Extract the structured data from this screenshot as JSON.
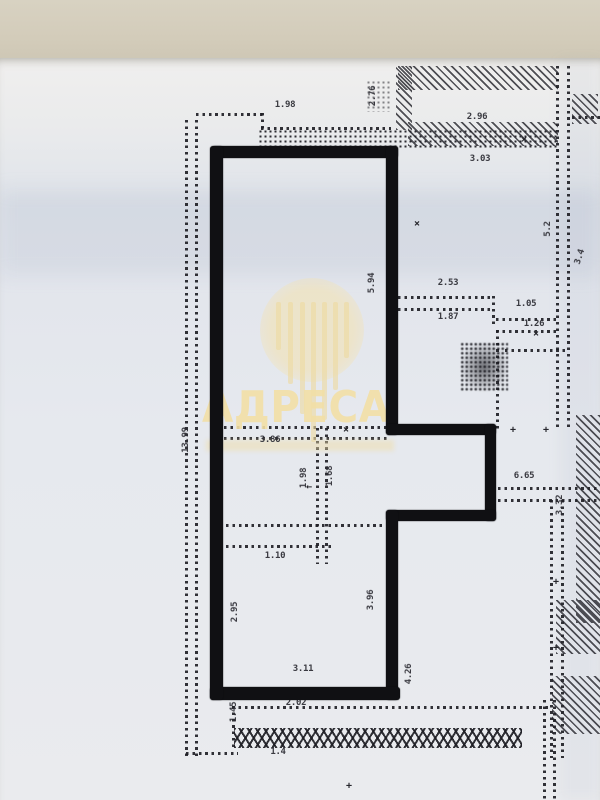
{
  "scene": {
    "description_kind": "photographed apartment floor plan with marked unit",
    "colors": {
      "table_top": "#d3ccba",
      "paper": "#e8eaee",
      "plan_ink": "#26262c",
      "marker_outline": "#101013",
      "watermark": "#f2dfa5"
    }
  },
  "watermark": {
    "text": "АДРЕСА",
    "logo": "circle-with-dripping-columns-logo"
  },
  "dimensions": [
    {
      "text": "1.98",
      "x": 285,
      "y": 105,
      "rot": 0
    },
    {
      "text": "2.76",
      "x": 373,
      "y": 96,
      "rot": -90
    },
    {
      "text": "2.96",
      "x": 477,
      "y": 117,
      "rot": 0
    },
    {
      "text": "3.03",
      "x": 480,
      "y": 159,
      "rot": 0
    },
    {
      "text": "2.53",
      "x": 448,
      "y": 283,
      "rot": 0
    },
    {
      "text": "1.87",
      "x": 448,
      "y": 317,
      "rot": 0
    },
    {
      "text": "1.05",
      "x": 526,
      "y": 304,
      "rot": 0
    },
    {
      "text": "1.26",
      "x": 534,
      "y": 324,
      "rot": 0
    },
    {
      "text": "5.94",
      "x": 372,
      "y": 283,
      "rot": -90
    },
    {
      "text": "5.2",
      "x": 548,
      "y": 229,
      "rot": -90
    },
    {
      "text": "3.4",
      "x": 580,
      "y": 257,
      "rot": -72
    },
    {
      "text": "13.99",
      "x": 186,
      "y": 440,
      "rot": -90
    },
    {
      "text": "3.86",
      "x": 270,
      "y": 440,
      "rot": 0
    },
    {
      "text": "1.98",
      "x": 304,
      "y": 478,
      "rot": -90
    },
    {
      "text": "1.68",
      "x": 330,
      "y": 476,
      "rot": -90
    },
    {
      "text": "6.65",
      "x": 524,
      "y": 476,
      "rot": 0
    },
    {
      "text": "3.32",
      "x": 560,
      "y": 505,
      "rot": -90
    },
    {
      "text": "1.10",
      "x": 275,
      "y": 556,
      "rot": 0
    },
    {
      "text": "2.95",
      "x": 235,
      "y": 612,
      "rot": -90
    },
    {
      "text": "3.96",
      "x": 371,
      "y": 600,
      "rot": -90
    },
    {
      "text": "4.26",
      "x": 409,
      "y": 674,
      "rot": -90
    },
    {
      "text": "3.11",
      "x": 303,
      "y": 669,
      "rot": 0
    },
    {
      "text": "2.02",
      "x": 296,
      "y": 703,
      "rot": 0
    },
    {
      "text": "1.45",
      "x": 234,
      "y": 712,
      "rot": -90
    },
    {
      "text": "1.4",
      "x": 278,
      "y": 752,
      "rot": 0
    }
  ],
  "ticks": [
    {
      "symbol": "×",
      "x": 524,
      "y": 140
    },
    {
      "symbol": "×",
      "x": 417,
      "y": 224
    },
    {
      "symbol": "×",
      "x": 346,
      "y": 430
    },
    {
      "symbol": "+",
      "x": 513,
      "y": 430
    },
    {
      "symbol": "+",
      "x": 546,
      "y": 430
    },
    {
      "symbol": "×",
      "x": 536,
      "y": 334
    },
    {
      "symbol": "×",
      "x": 489,
      "y": 514
    },
    {
      "symbol": "+",
      "x": 556,
      "y": 582
    },
    {
      "symbol": "+",
      "x": 556,
      "y": 648
    },
    {
      "symbol": "←",
      "x": 309,
      "y": 487
    },
    {
      "symbol": "+",
      "x": 349,
      "y": 786
    }
  ]
}
